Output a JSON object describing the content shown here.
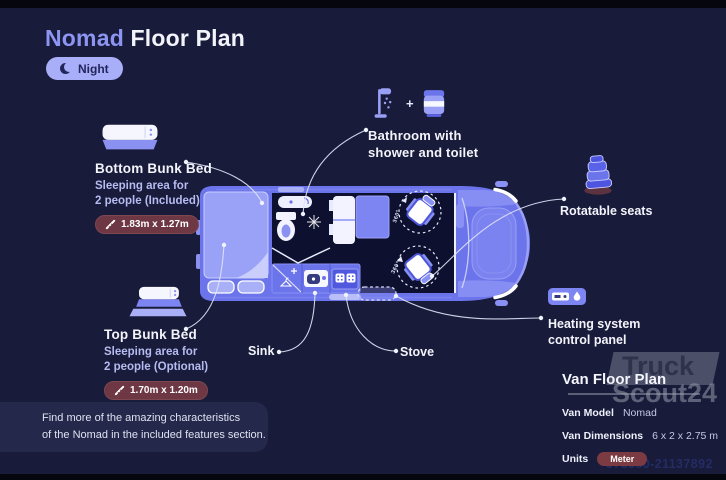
{
  "header": {
    "title_brand": "Nomad",
    "title_rest": "Floor Plan",
    "mode_label": "Night"
  },
  "annotations": {
    "bottom_bunk": {
      "title": "Bottom Bunk Bed",
      "desc_line1": "Sleeping area for",
      "desc_line2": "2 people (Included)",
      "dimensions": "1.83m x 1.27m"
    },
    "top_bunk": {
      "title": "Top Bunk Bed",
      "desc_line1": "Sleeping area for",
      "desc_line2": "2 people (Optional)",
      "dimensions": "1.70m x 1.20m"
    },
    "bathroom": {
      "line1": "Bathroom with",
      "line2": "shower and toilet",
      "icon_joiner": "+"
    },
    "rotatable_seats": {
      "label": "Rotatable seats"
    },
    "heating": {
      "line1": "Heating system",
      "line2": "control panel"
    },
    "sink": {
      "label": "Sink"
    },
    "stove": {
      "label": "Stove"
    }
  },
  "floorplan": {
    "rotation_label": "360°"
  },
  "info_panel": {
    "title": "Van Floor Plan",
    "rows": [
      {
        "label": "Van Model",
        "value": "Nomad"
      },
      {
        "label": "Van Dimensions",
        "value": "6 x 2 x 2.75 m"
      },
      {
        "label": "Units",
        "value": "Meter"
      }
    ]
  },
  "footer_note": {
    "line1": "Find more of the amazing characteristics",
    "line2": "of the Nomad in the included features section."
  },
  "watermark": {
    "line1": "Truck",
    "line2": "Scout24"
  },
  "listing_id": "573580-21137892",
  "colors": {
    "background": "#181b3a",
    "accent": "#8d95f2",
    "night_pill": "#a9aef8",
    "badge_maroon": "#6d3743",
    "van_body": "#6b74ea",
    "interior_dark": "#0d102e",
    "text_primary": "#f3f4fb",
    "text_secondary": "#b6bbf0"
  }
}
